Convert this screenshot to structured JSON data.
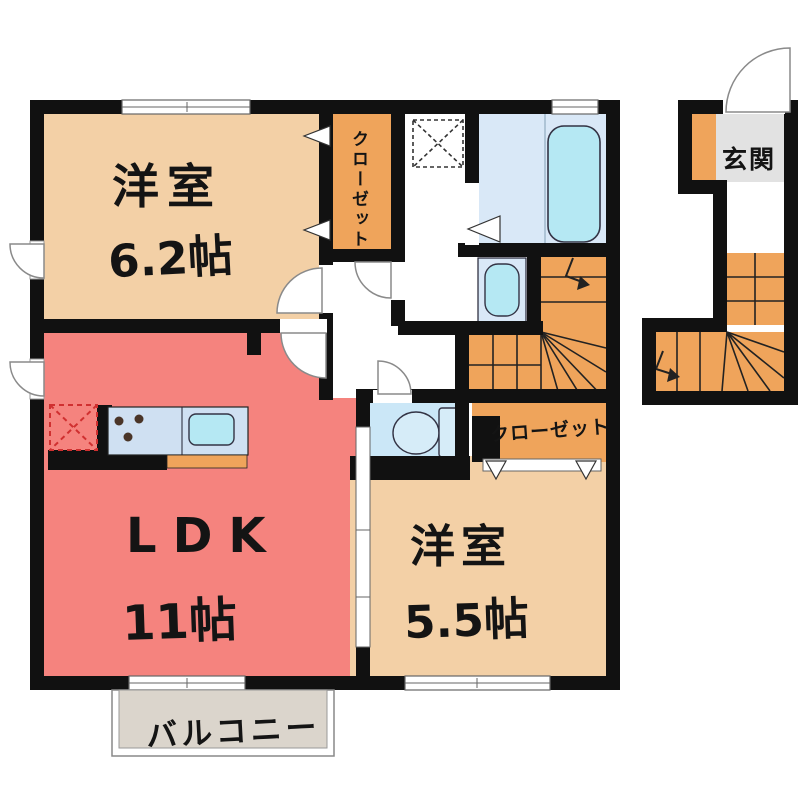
{
  "page": {
    "background": "#FFFFFF",
    "type": "apartment-floor-plan"
  },
  "colors": {
    "wall": "#111111",
    "room_beige": "#F3D0A6",
    "ldk_salmon": "#F5837E",
    "closet_orange": "#EFA45B",
    "water_blue": "#D9E8F7",
    "fixture_cyan": "#B5E8F3",
    "toilet_blue": "#CBE7F7",
    "counter_blue": "#CFE0F2",
    "balcony_gray": "#DBD5CC",
    "genkan_gray": "#E2E2E2",
    "fridge_dash_red": "#D03030",
    "door_line": "#8A8A8A",
    "stair_line": "#222222"
  },
  "labels": {
    "bedroom1_name": "洋室",
    "bedroom1_size": "6.2帖",
    "ldk_name": "LDK",
    "ldk_size": "11帖",
    "bedroom2_name": "洋室",
    "bedroom2_size": "5.5帖",
    "closet_upper": "クローゼット",
    "closet_lower": "クローゼット",
    "entrance": "玄関",
    "balcony": "バルコニー"
  }
}
